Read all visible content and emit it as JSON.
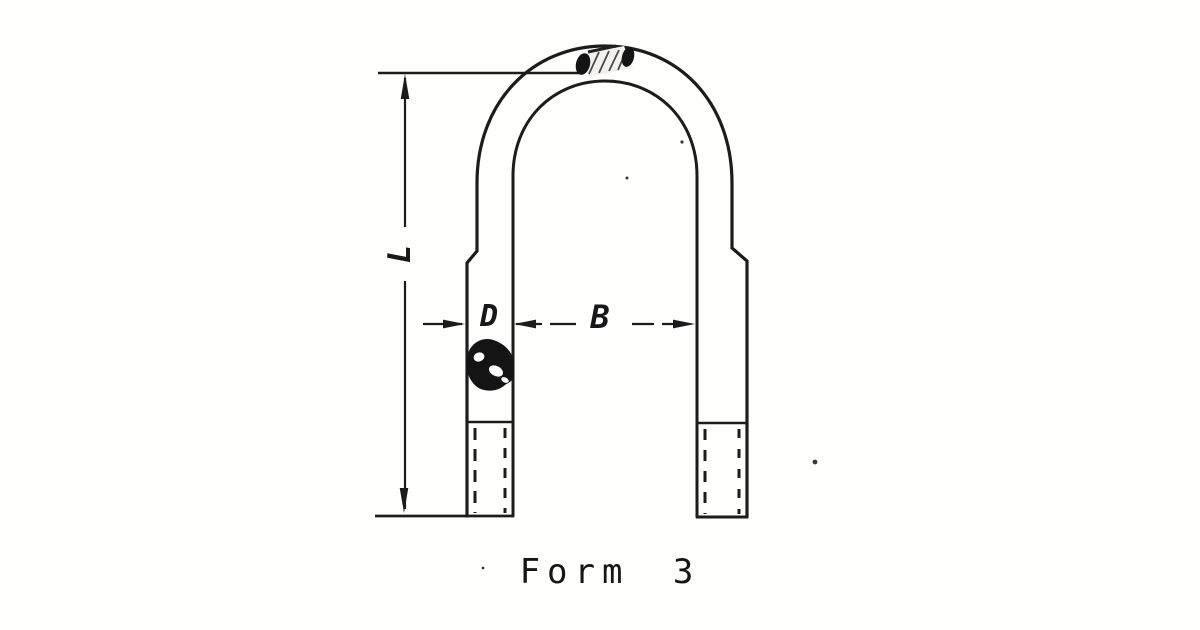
{
  "figure": {
    "caption": "Form 3",
    "labels": {
      "length": "L",
      "rod_diameter": "D",
      "inside_width": "B"
    },
    "colors": {
      "ink": "#1c1c1c",
      "paper": "#fefefd"
    }
  }
}
